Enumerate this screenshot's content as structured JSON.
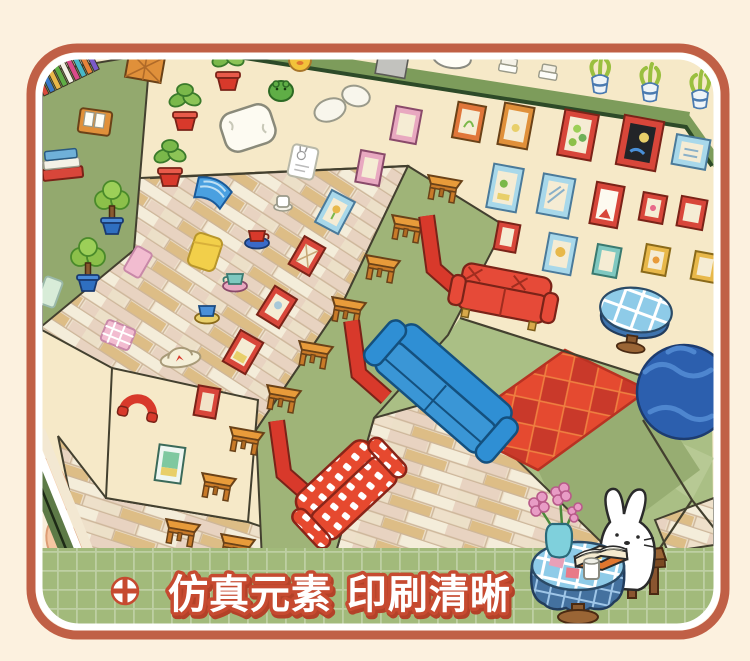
{
  "product_card": {
    "type": "product marketing photo",
    "subject": "isometric room sticker-book page held by a hand"
  },
  "banner": {
    "icon": "cross-circle-icon",
    "text": "仿真元素 印刷清晰",
    "background": "#a2ba7b",
    "grid_line": "#ffffff",
    "text_fill": "#ffffff",
    "text_outline": "#c64a30"
  },
  "palette": {
    "page_bg": "#fcf1df",
    "card_border": "#c06046",
    "card_inner_stripe": "#ffffff",
    "wall_cream": "#f6e9c8",
    "wall_green": "#93a96e",
    "platform_green": "#9fb478",
    "floor_green": "#aabf85",
    "ledge_green": "#7d9c5b",
    "parquet_light": "#efe3cf",
    "parquet_tan": "#ddbd86",
    "sofa_red": "#e64a38",
    "sofa_blue": "#2f8fd4",
    "rug_red": "#e54a30",
    "table_orange": "#e89b3a",
    "sphere_blue": "#2c5fae",
    "tablecloth_blue": "#8ecbe8",
    "book_edge_green": "#5d7a47",
    "hand_skin": "#f5c6a2"
  },
  "scene": {
    "stickers": [
      "bookshelf-spines",
      "book-stack",
      "book-box",
      "potted-plant-red",
      "topiary-tree-blue-pot",
      "pillow",
      "crumpled-paper",
      "yellow-duck",
      "green-frog",
      "bunny-card",
      "picture-frame",
      "side-table",
      "corner-arrow",
      "red-sofa",
      "blue-sofa",
      "checkered-sofa",
      "argyle-rug",
      "round-plaid-table",
      "blue-sphere",
      "teacup",
      "paper-scrap",
      "sun-hat",
      "red-arch",
      "ledge-plant",
      "gray-cabinet",
      "sleeping-cat",
      "pink-blanket"
    ],
    "vignette": [
      "reading-bunny",
      "flower-vase",
      "open-book",
      "cup",
      "stool",
      "round-cloth-table"
    ]
  }
}
